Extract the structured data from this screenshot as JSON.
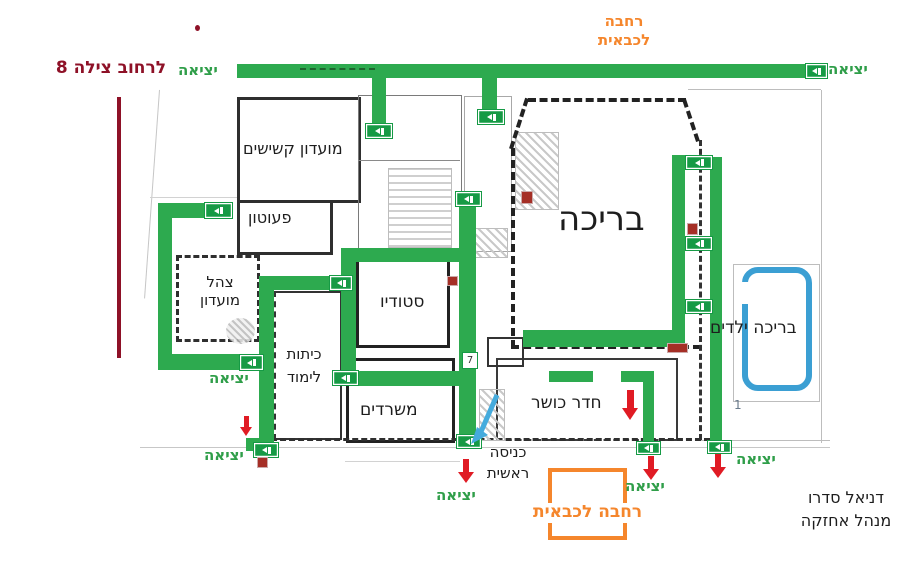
{
  "labels": {
    "street": "לרחוב צילה 8",
    "exit": "יציאה",
    "fire_area_top": [
      "רחבה",
      "לכבאית"
    ],
    "fire_area_bottom": "רחבה לכבאית",
    "rooms": {
      "seniors_club": "מועדון קשישים",
      "nursery": "פעוטון",
      "tzahal_club": [
        "צהל",
        "מועדון"
      ],
      "studio": "סטודיו",
      "pool": "בריכה",
      "kids_pool": "בריכה ילדים",
      "classrooms": [
        "כיתות",
        "לימוד"
      ],
      "offices": "משרדים",
      "gym": "חדר כושר"
    },
    "main_entrance": [
      "כניסה",
      "ראשית"
    ],
    "manager": [
      "דניאל  סדרו",
      "מנהל אחזקה"
    ],
    "marker_7": "7",
    "marker_1": "1"
  },
  "colors": {
    "route_green": "#2daa4f",
    "exit_sign_green": "#169a45",
    "exit_text_green": "#2f9e49",
    "fire_area_orange": "#f5862c",
    "arrow_red": "#e01b24",
    "street_dark_red": "#8e1127",
    "kids_pool_blue": "#3b9fd3",
    "wall_dark": "#2b2b2b"
  }
}
